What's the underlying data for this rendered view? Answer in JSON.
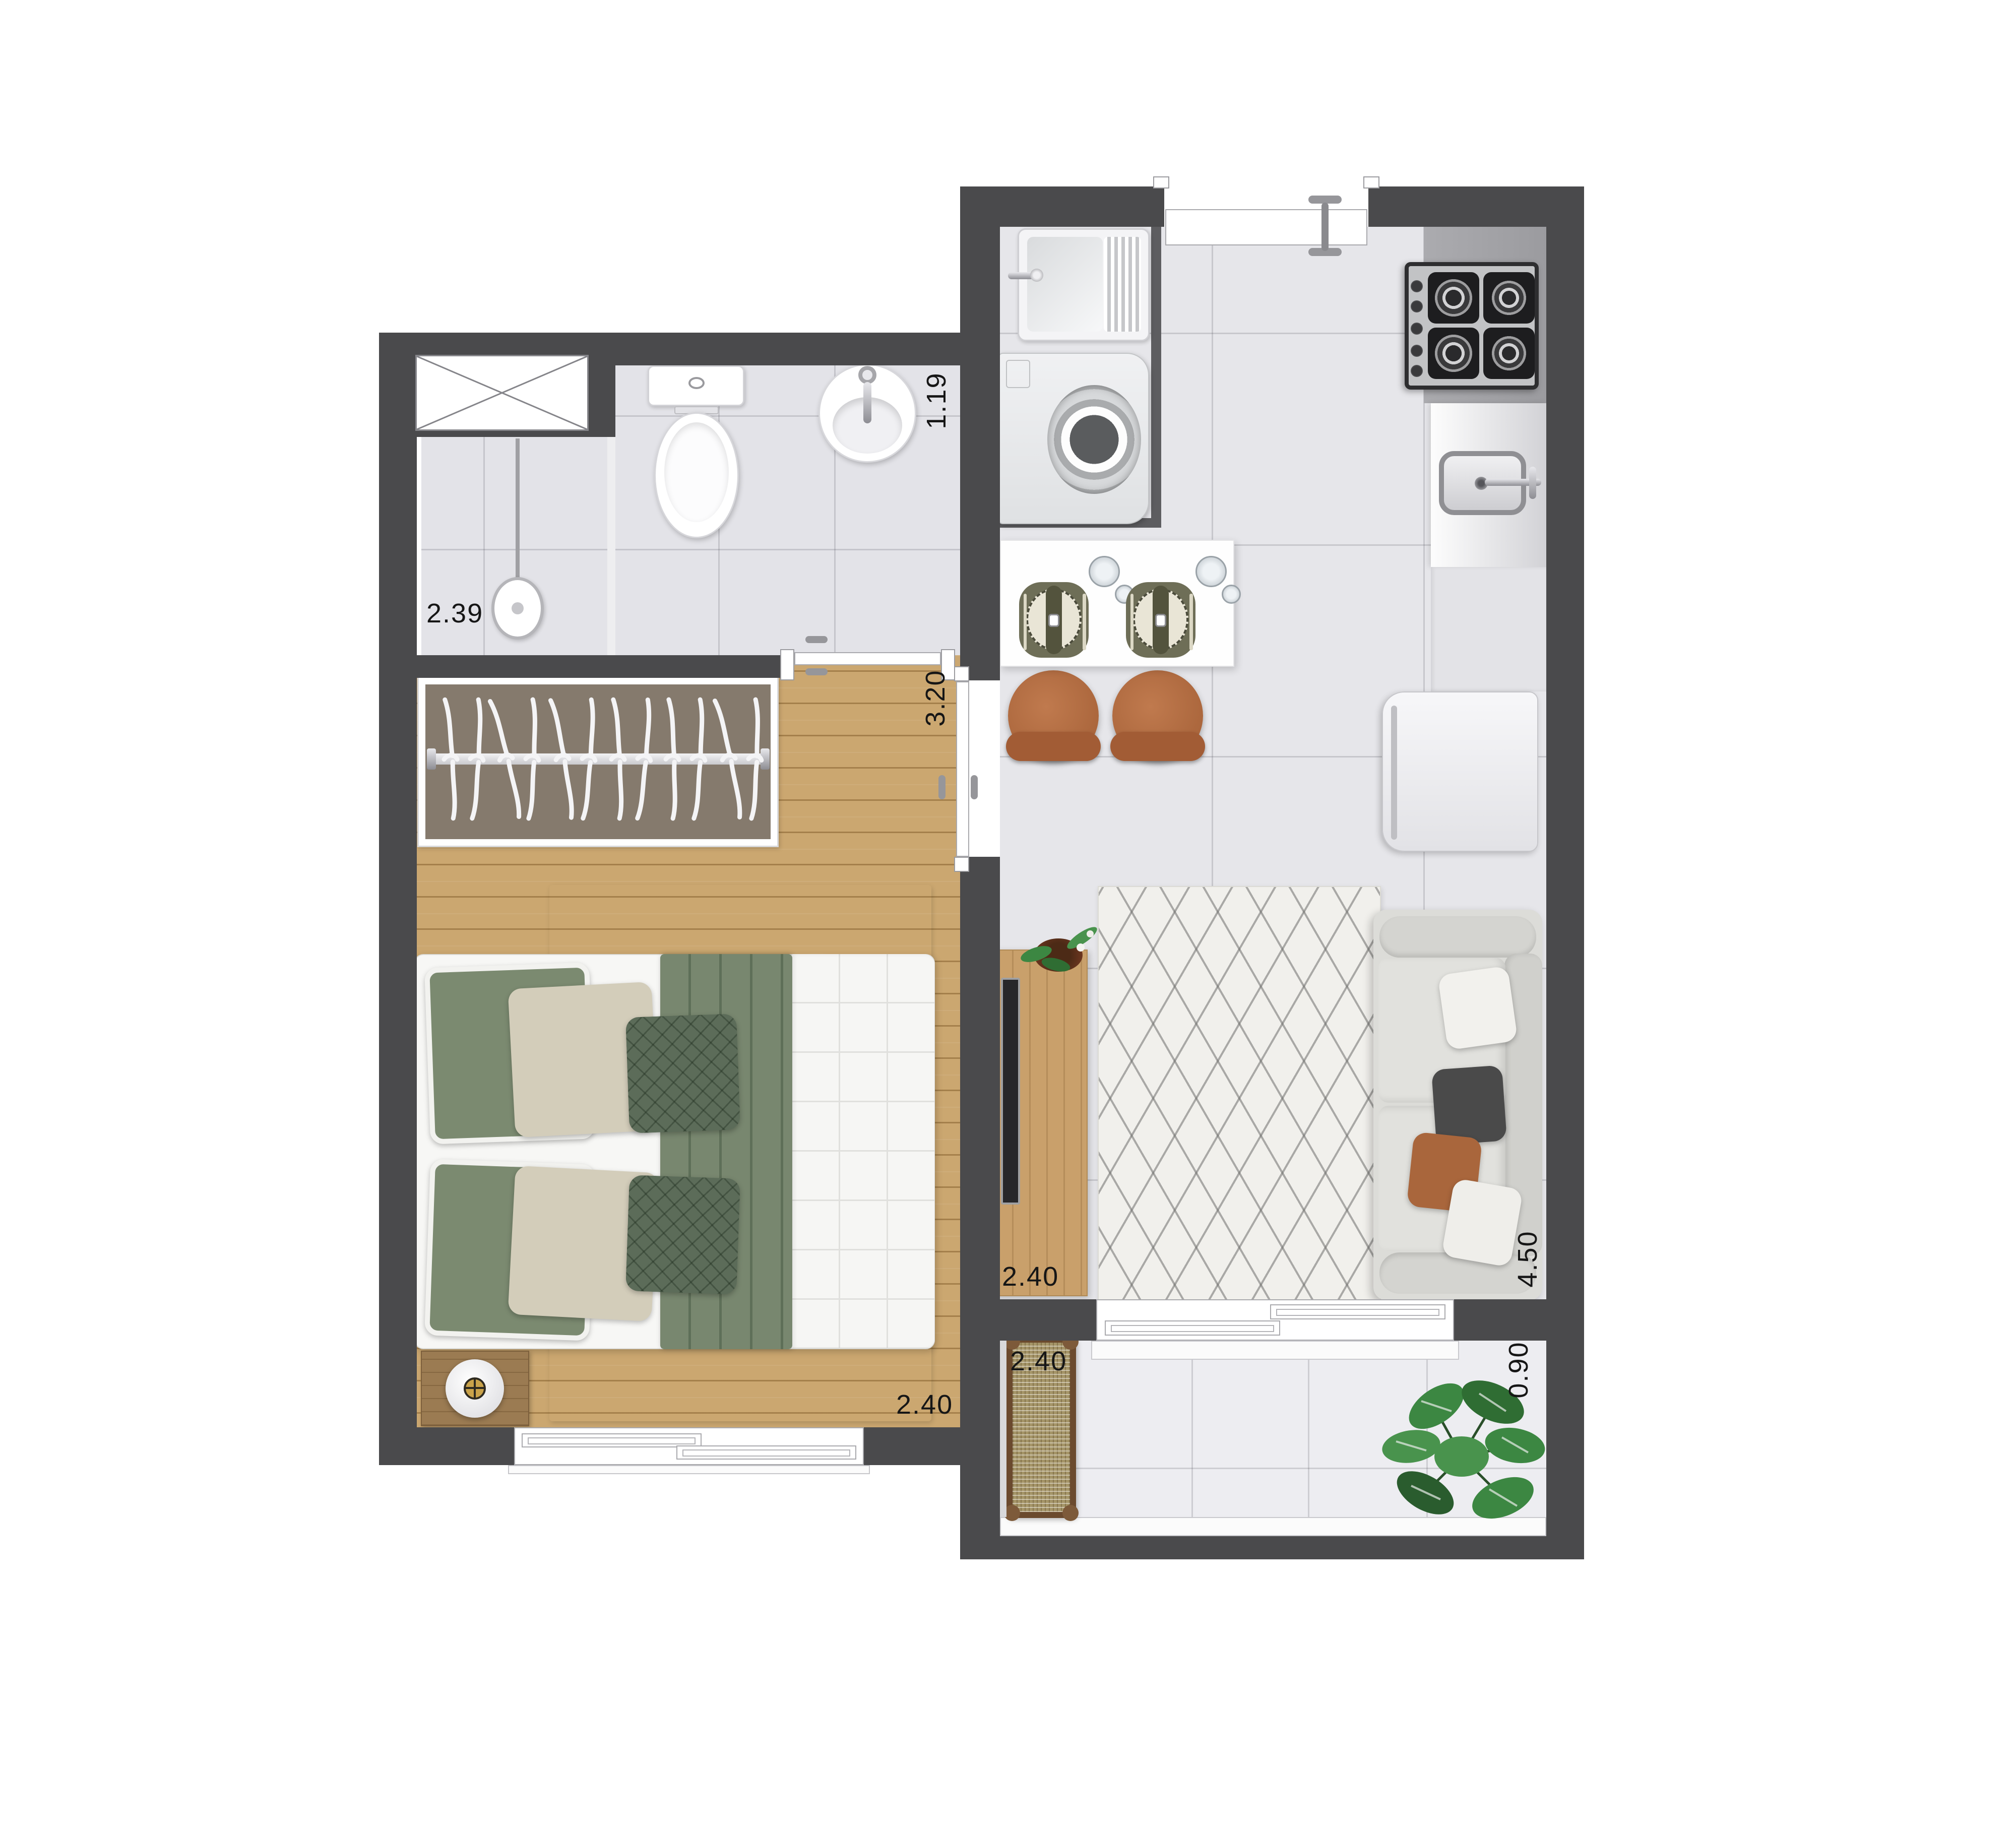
{
  "plan_type": "apartment-floor-plan",
  "labels": [
    {
      "id": "shower-dim",
      "text": "2.39",
      "orientation": "horizontal"
    },
    {
      "id": "bathroom-dim",
      "text": "1.19",
      "orientation": "vertical"
    },
    {
      "id": "bedroom-length-dim",
      "text": "3.20",
      "orientation": "vertical"
    },
    {
      "id": "bedroom-width-dim",
      "text": "2.40",
      "orientation": "horizontal"
    },
    {
      "id": "living-width-dim",
      "text": "2.40",
      "orientation": "horizontal"
    },
    {
      "id": "living-length-dim",
      "text": "4.50",
      "orientation": "vertical"
    },
    {
      "id": "balcony-width-dim",
      "text": "2.40",
      "orientation": "horizontal"
    },
    {
      "id": "balcony-depth-dim",
      "text": "0.90",
      "orientation": "vertical"
    }
  ],
  "colors": {
    "wall": "#4a4a4c",
    "partition_wall": "#5d5d60",
    "tile_floor": "#e6e6ea",
    "wood_floor": "#cba770",
    "label_text": "#161616",
    "sofa": "#dcdcd8",
    "accent_rust": "#b06a41",
    "accent_sage": "#7b8a70",
    "plant_green": "#3c8742"
  }
}
